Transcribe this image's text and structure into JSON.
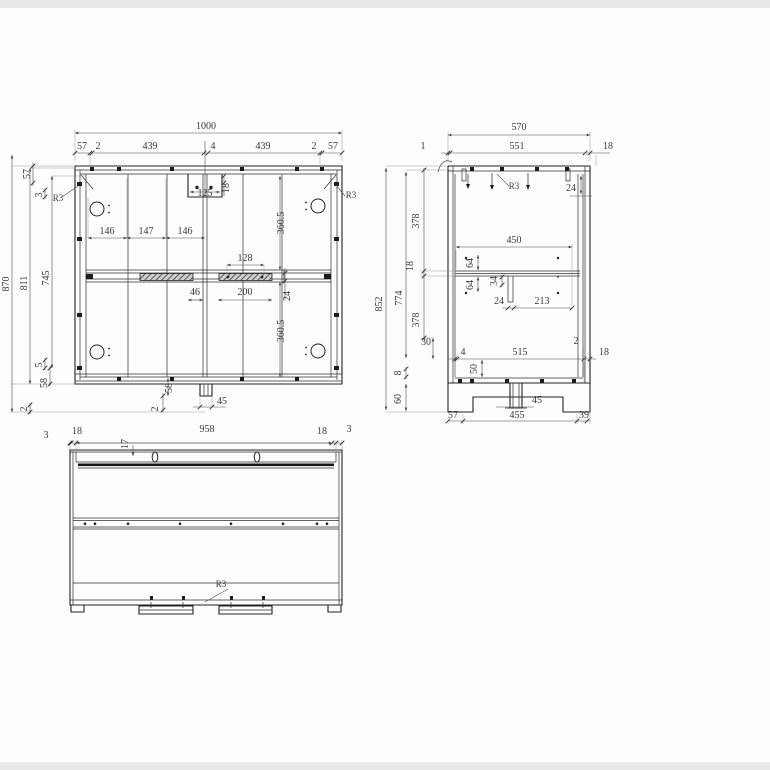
{
  "drawing_type": "furniture cabinet technical drawing, three orthographic views",
  "views": {
    "front": {
      "top": [
        "1000",
        "57",
        "2",
        "439",
        "4",
        "439",
        "2",
        "57"
      ],
      "left": [
        "870",
        "811",
        "745",
        "57",
        "3",
        "R3",
        "5",
        "58",
        "2"
      ],
      "center": [
        "125",
        "18",
        "146",
        "147",
        "146",
        "360.5",
        "128",
        "46",
        "200",
        "24",
        "360.5"
      ],
      "bottom": [
        "58",
        "2",
        "45"
      ],
      "right": [
        "R3"
      ]
    },
    "side": {
      "top": [
        "570",
        "1",
        "551",
        "18",
        "R3",
        "24"
      ],
      "left": [
        "852",
        "774",
        "378",
        "18",
        "378",
        "30",
        "8",
        "60"
      ],
      "middle": [
        "450",
        "64",
        "64",
        "34",
        "24",
        "213"
      ],
      "bottom": [
        "4",
        "515",
        "2",
        "18",
        "50",
        "45",
        "57",
        "455",
        "39"
      ]
    },
    "plan": {
      "top": [
        "3",
        "18",
        "958",
        "18",
        "3",
        "17"
      ],
      "bottom": [
        "R3"
      ]
    }
  },
  "colors": {
    "line": "#232323",
    "dim": "#4d4d4d",
    "background": "#fdfdfd"
  }
}
